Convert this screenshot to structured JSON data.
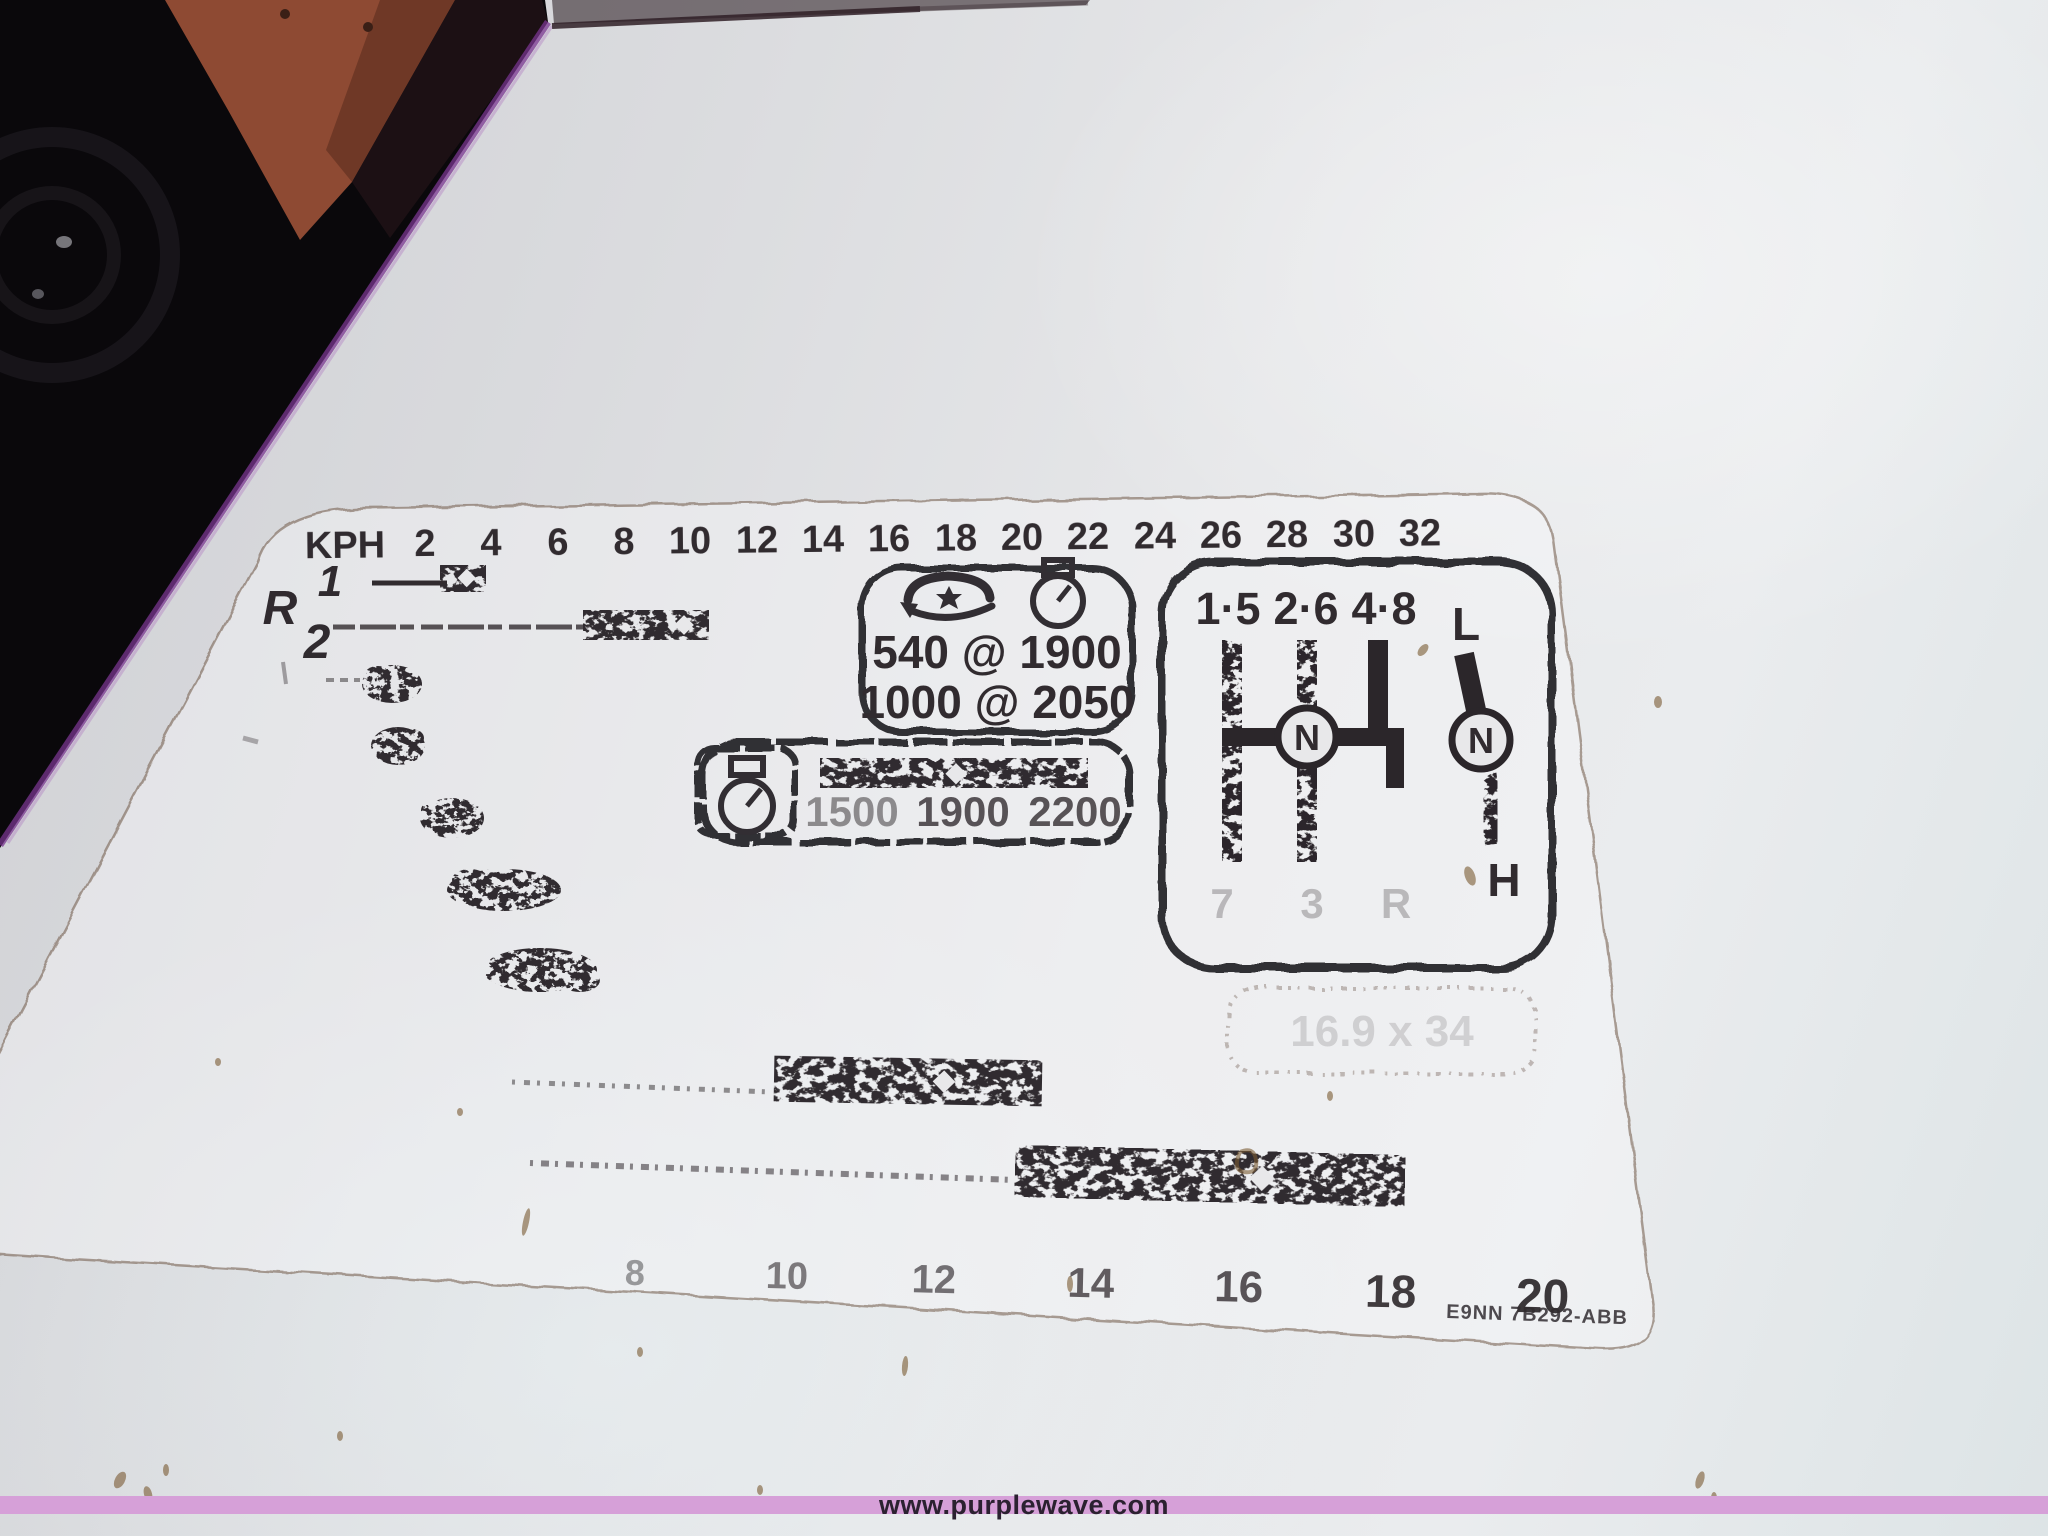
{
  "photo": {
    "watermark_text": "www.purplewave.com",
    "part_number": "E9NN 7B292-ABB"
  },
  "decal": {
    "unit_label": "KPH",
    "kph_ticks": [
      "2",
      "4",
      "6",
      "8",
      "10",
      "12",
      "14",
      "16",
      "18",
      "20",
      "22",
      "24",
      "26",
      "28",
      "30",
      "32"
    ],
    "reverse_label": "R",
    "reverse_gear_1": "1",
    "reverse_gear_2": "2",
    "pto": {
      "speed_540": "540 @ 1900",
      "speed_1000": "1000 @ 2050"
    },
    "engine_rpm": {
      "v1": "1500",
      "v2": "1900",
      "v3": "2200"
    },
    "shift": {
      "top_1": "1·5",
      "top_2": "2·6",
      "top_3": "4·8",
      "bottom_1": "7",
      "bottom_2": "3",
      "bottom_3": "R",
      "neutral": "N",
      "range_low": "L",
      "range_neutral": "N",
      "range_high": "H"
    },
    "tire_size": "16.9 x 34",
    "mph_ticks": [
      "8",
      "10",
      "12",
      "14",
      "16",
      "18",
      "20"
    ]
  },
  "colors": {
    "fender": "#e2e4e6",
    "tractor_orange": "#8e4a33",
    "tire_black": "#0a080b",
    "decal_ink": "#211c20",
    "watermark_band": "#d6a0d8",
    "edge_fringe": "#7a3590"
  }
}
